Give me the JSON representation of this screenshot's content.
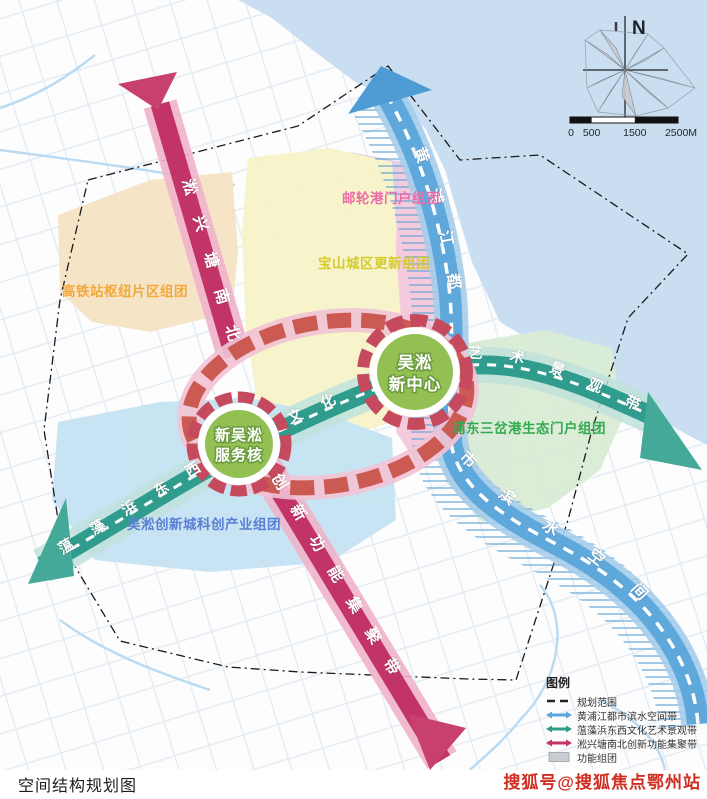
{
  "caption": "空间结构规划图",
  "watermark": "搜狐号@搜狐焦点鄂州站",
  "compass": {
    "north": "N"
  },
  "scalebar": {
    "t0": "0",
    "t1": "500",
    "t2": "1500",
    "t3": "2500M"
  },
  "colors": {
    "water": "#c9def1",
    "river_core": "#5aa5da",
    "river_light": "#a6cdeb",
    "river_arrow": "#4f9bd3",
    "canal_core": "#2f9c8e",
    "canal_light": "#bfe2dc",
    "canal_arrow": "#45a99a",
    "axis_core": "#c23468",
    "axis_light": "#efb3ca",
    "axis_arrow": "#c8406d",
    "loop_red": "#cb5a52",
    "loop_pink": "#f2c3d6",
    "ring_red": "#c64a5e",
    "core_green": "#93c052",
    "area_orange": "#f6e3c4",
    "area_yellow": "#f7f3c8",
    "area_pink": "#f4c9dc",
    "area_lavender": "#dbcfe9",
    "area_blue": "#c5e3f3",
    "area_green": "#d9ecd5",
    "boundary": "#1a1a1a"
  },
  "bands": {
    "river": {
      "name": "黄浦江都市滨水空间带",
      "seg_upper": "黄浦江都",
      "seg_lower": "市滨水空间带"
    },
    "canal": {
      "name": "蕰藻浜东西文化艺术景观带",
      "seg_left": "蕰藻浜东西",
      "seg_mid": "文化",
      "seg_right": "艺术景观带"
    },
    "axis": {
      "name": "淞兴塘南北创新功能集聚带",
      "seg_top": "淞兴塘南北",
      "seg_bottom": "创新功能集聚带"
    }
  },
  "cores": {
    "center": {
      "line1": "吴淞",
      "line2": "新中心"
    },
    "service": {
      "line1": "新吴淞",
      "line2": "服务核"
    }
  },
  "districts": [
    {
      "label": "高铁站枢纽片区组团",
      "color": "#f2a93c"
    },
    {
      "label": "邮轮港门户组团",
      "color": "#ee6aa8"
    },
    {
      "label": "宝山城区更新组团",
      "color": "#d6ca30"
    },
    {
      "label": "浦东三岔港生态门户组团",
      "color": "#33a94f"
    },
    {
      "label": "吴淞创新城科创产业组团",
      "color": "#5a7fd2"
    }
  ],
  "legend": {
    "title": "图例",
    "items": [
      {
        "label": "规划范围",
        "color": "#222222",
        "type": "dash"
      },
      {
        "label": "黄浦江都市滨水空间带",
        "color": "#5aa5da",
        "type": "band"
      },
      {
        "label": "蕰藻浜东西文化艺术景观带",
        "color": "#2f9c8e",
        "type": "band"
      },
      {
        "label": "淞兴塘南北创新功能集聚带",
        "color": "#c23468",
        "type": "band"
      },
      {
        "label": "功能组团",
        "color": "#c9cdd2",
        "type": "area"
      }
    ]
  }
}
